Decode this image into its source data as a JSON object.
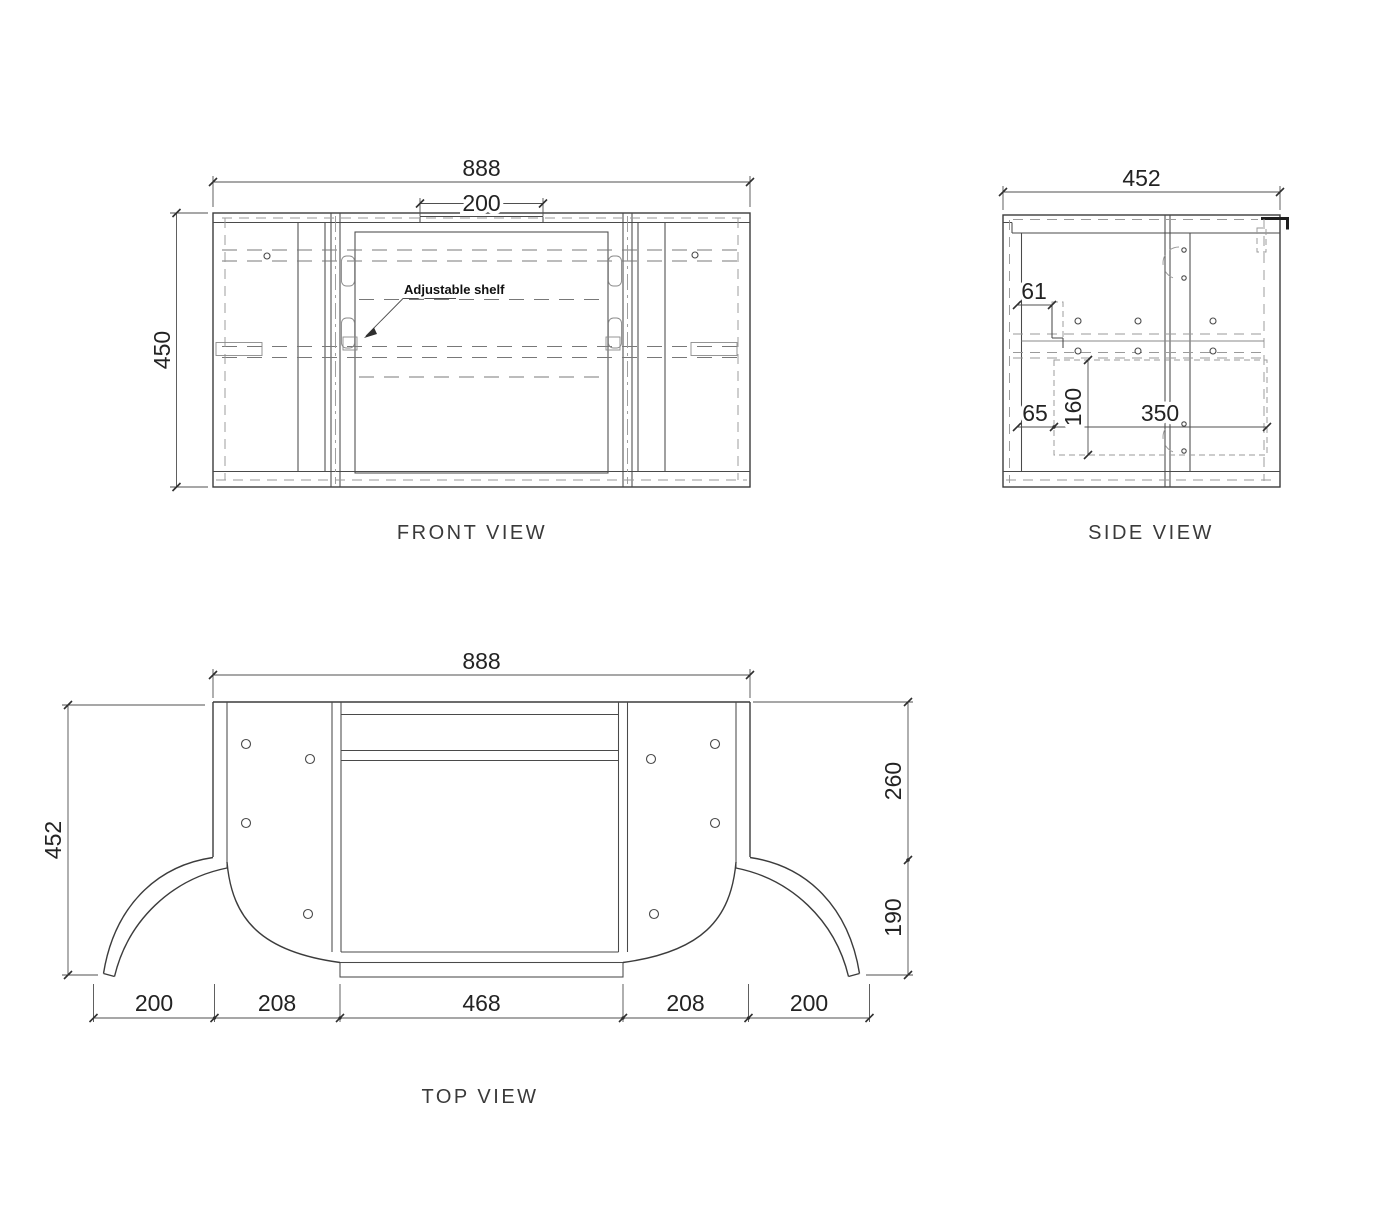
{
  "canvas": {
    "background": "#ffffff",
    "line_color": "#3c3c3c",
    "dash_color": "#8c8c8c"
  },
  "front_view": {
    "label": "FRONT VIEW",
    "dim_overall_width": "888",
    "dim_notch_width": "200",
    "dim_height": "450",
    "shelf_note": "Adjustable shelf"
  },
  "side_view": {
    "label": "SIDE VIEW",
    "dim_overall_depth": "452",
    "dim_bracket_offset": "61",
    "dim_back_offset": "65",
    "dim_drawer_height": "160",
    "dim_internal_depth": "350"
  },
  "top_view": {
    "label": "TOP VIEW",
    "dim_overall_width": "888",
    "dim_overall_depth": "452",
    "dim_back_depth": "260",
    "dim_front_depth": "190",
    "dim_segments": [
      "200",
      "208",
      "468",
      "208",
      "200"
    ]
  }
}
